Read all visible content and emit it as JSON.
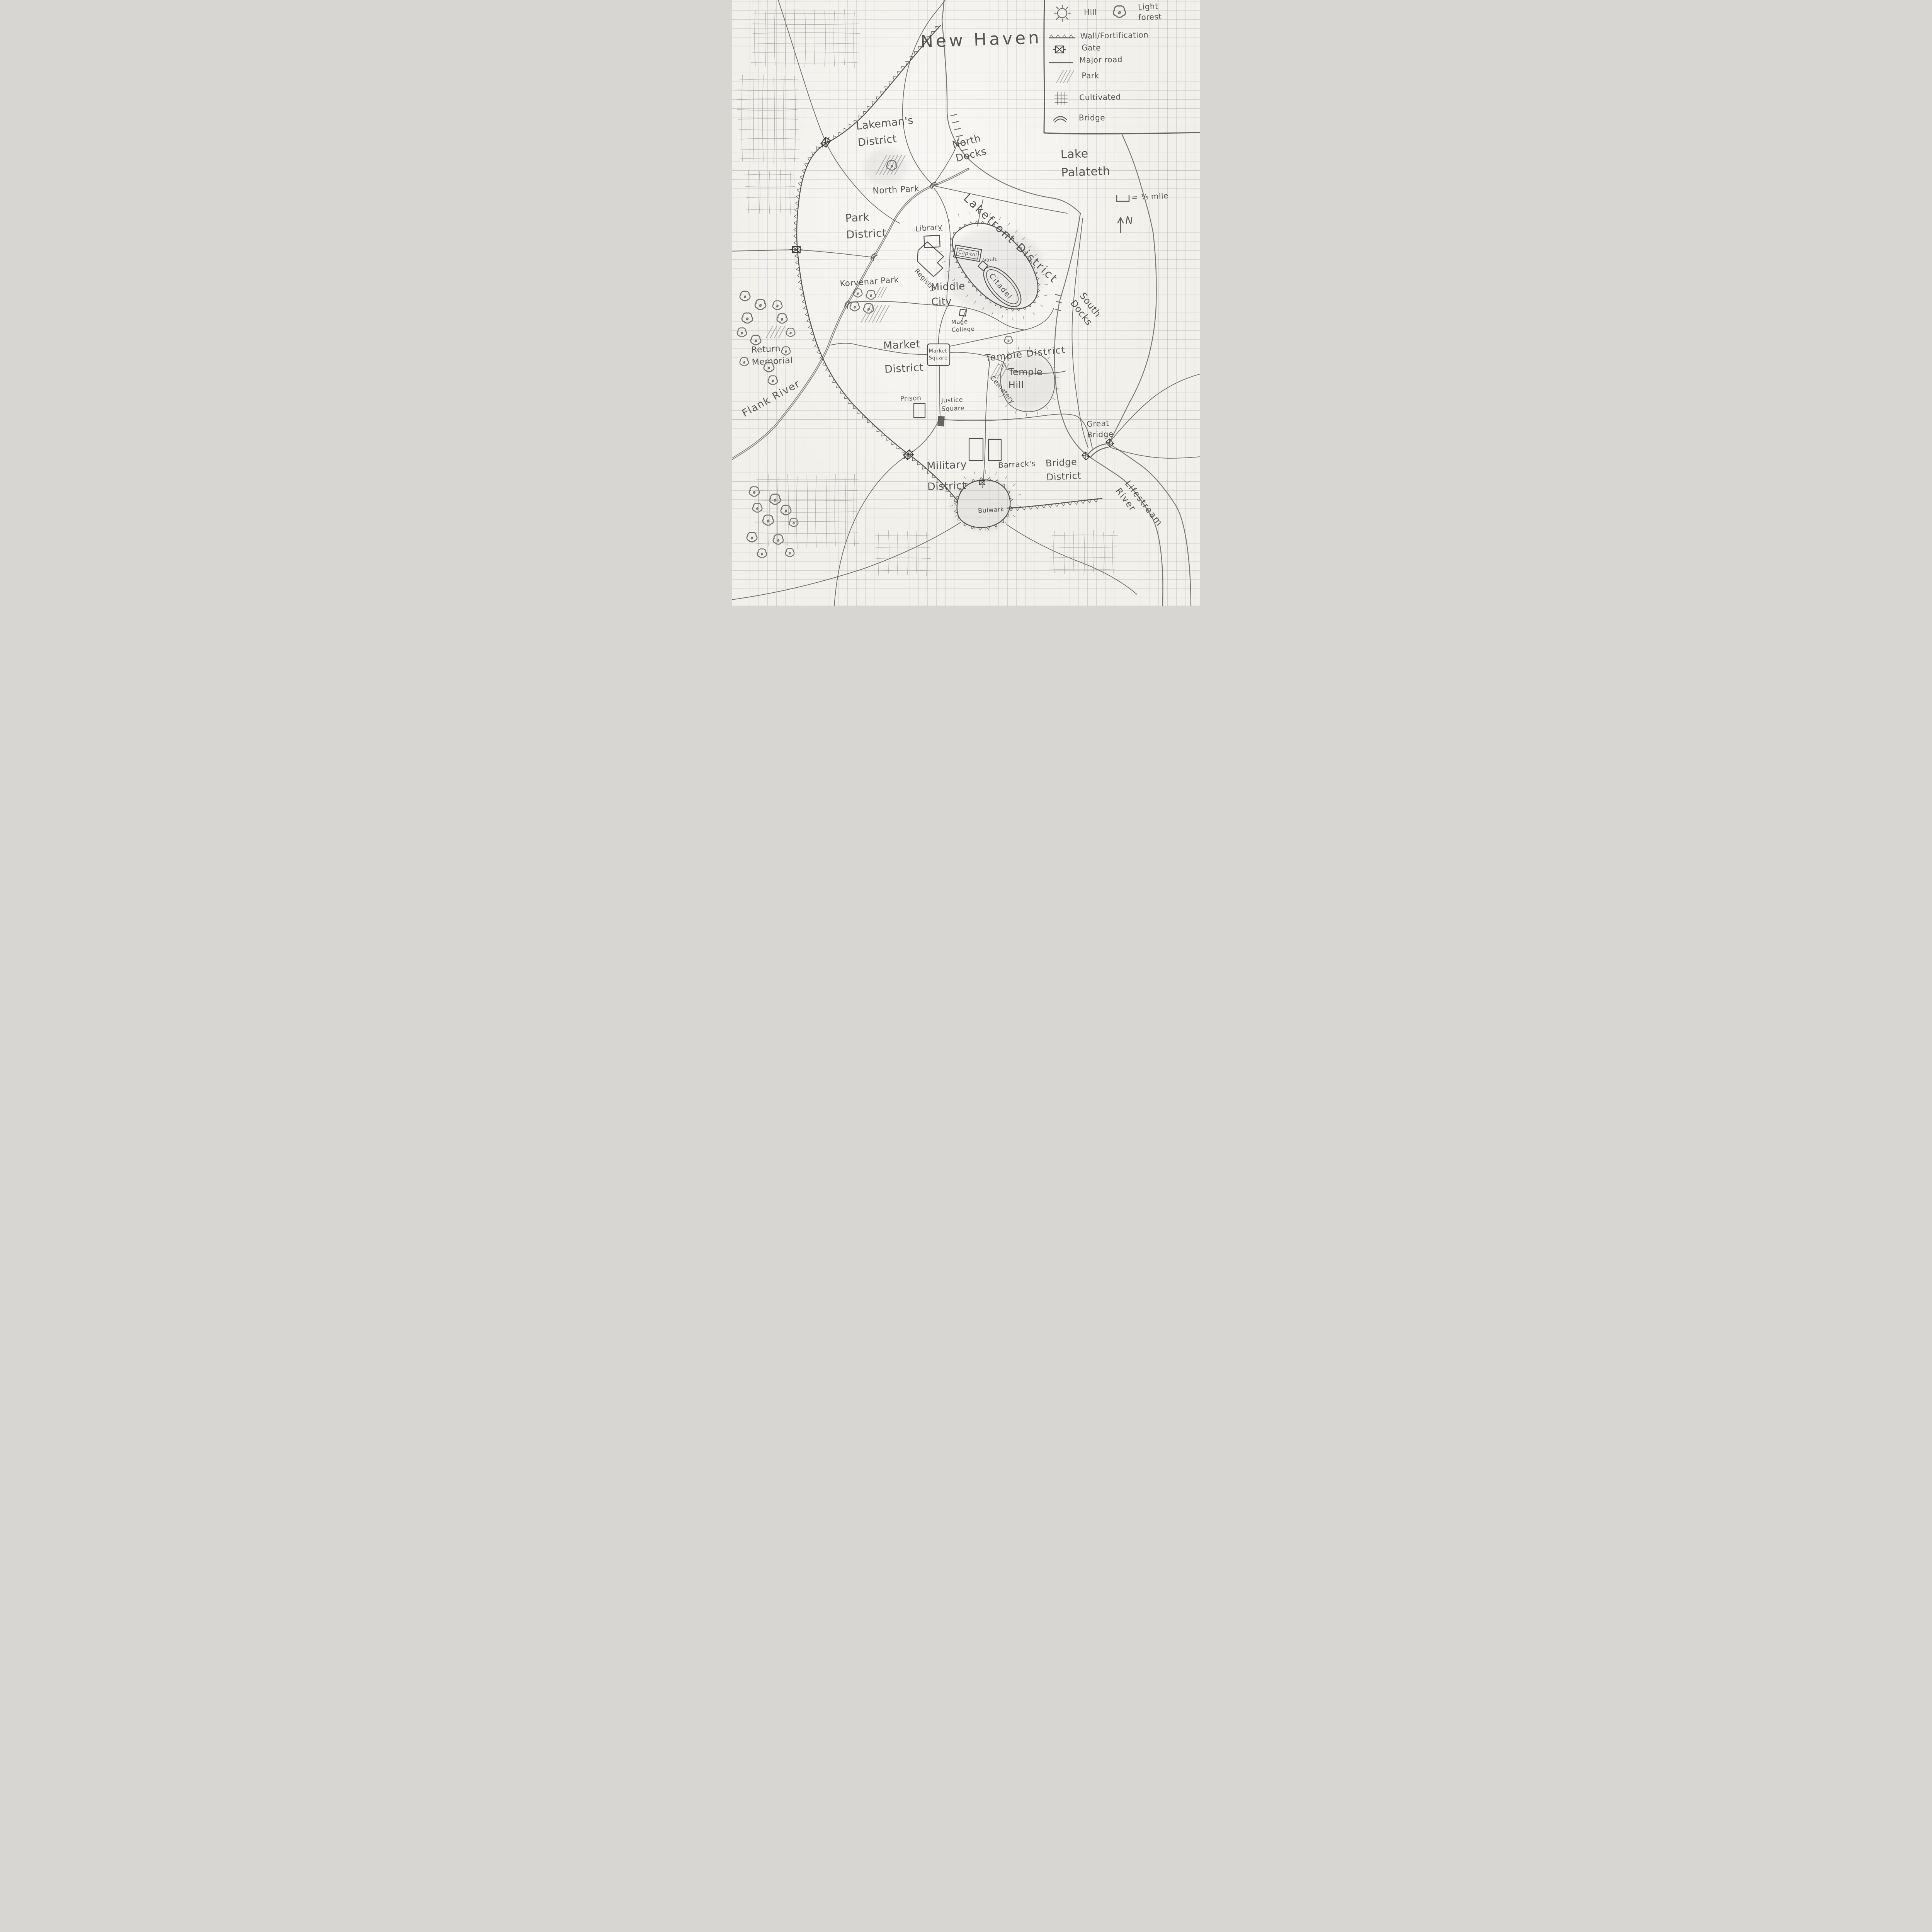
{
  "title": "New Haven",
  "colors": {
    "pencil": "#4d4d4d",
    "paper": "#f2f0eb",
    "grid": "#7d8791"
  },
  "legend": {
    "items": [
      {
        "id": "hill",
        "label": "Hill"
      },
      {
        "id": "light-forest",
        "label": "Light forest"
      },
      {
        "id": "wall",
        "label": "Wall/Fortification"
      },
      {
        "id": "gate",
        "label": "Gate"
      },
      {
        "id": "major-road",
        "label": "Major road"
      },
      {
        "id": "park",
        "label": "Park"
      },
      {
        "id": "cultivated",
        "label": "Cultivated"
      },
      {
        "id": "bridge",
        "label": "Bridge"
      }
    ]
  },
  "scale": {
    "label": "= ⅕ mile"
  },
  "compass": {
    "north_label": "N"
  },
  "water": {
    "lake": "Lake\nPalateth",
    "flank_river": "Flank River",
    "lifestream_river": "Lifestream River"
  },
  "districts": {
    "lakemans": "Lakeman's\nDistrict",
    "park": "Park\nDistrict",
    "lakefront": "Lakefront District",
    "middle_city": "Middle\nCity",
    "market": "Market\nDistrict",
    "temple": "Temple District",
    "military": "Military\nDistrict",
    "bridge": "Bridge\nDistrict"
  },
  "places": {
    "north_docks": "North\nDocks",
    "north_park": "North Park",
    "library": "Library",
    "capitol": "Capitol",
    "vault": "Vault",
    "citadel": "Citadel",
    "registry": "Registry",
    "mage_college": "Mage\nCollege",
    "korvenar_park": "Korvenar Park",
    "south_docks": "South\nDocks",
    "market_square": "Market\nSquare",
    "temple_hill": "Temple\nHill",
    "cemetery": "Cemetery",
    "return_memorial": "Return\nMemorial",
    "prison": "Prison",
    "justice_square": "Justice\nSquare",
    "barracks": "Barrack's",
    "great_bridge": "Great\nBridge",
    "bulwark": "Bulwark"
  }
}
